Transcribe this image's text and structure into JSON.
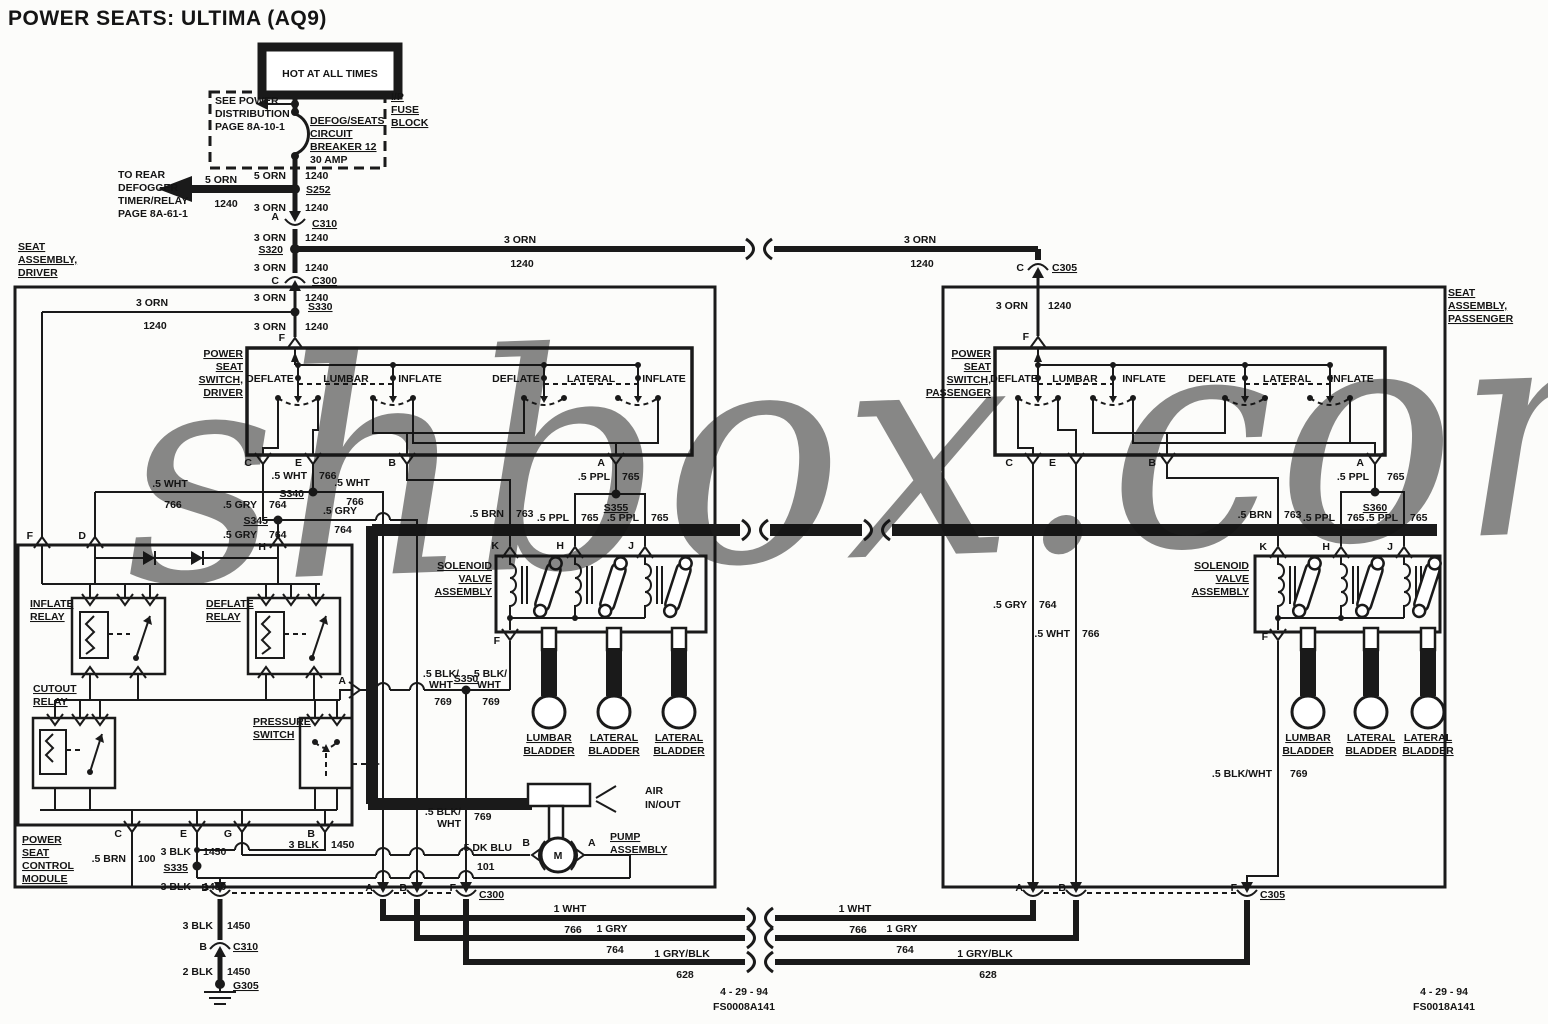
{
  "title": "POWER SEATS: ULTIMA (AQ9)",
  "watermark": "shbox.com",
  "colors": {
    "ink": "#1a1a1a",
    "watermark": "#8f99e6",
    "paper": "#fcfcfa"
  },
  "header": {
    "hot": "HOT AT ALL TIMES",
    "see_power": [
      "SEE POWER",
      "DISTRIBUTION",
      "PAGE 8A-10-1"
    ],
    "fuse_block": [
      "I/P",
      "FUSE",
      "BLOCK"
    ],
    "breaker": [
      "DEFOG/SEATS",
      "CIRCUIT",
      "BREAKER 12",
      "30 AMP"
    ],
    "to_rear": [
      "TO REAR",
      "DEFOGGER",
      "TIMER/RELAY",
      "PAGE 8A-61-1"
    ]
  },
  "boxes": {
    "seat_driver": [
      "SEAT",
      "ASSEMBLY,",
      "DRIVER"
    ],
    "seat_passenger": [
      "SEAT",
      "ASSEMBLY,",
      "PASSENGER"
    ],
    "switch_driver": [
      "POWER",
      "SEAT",
      "SWITCH,",
      "DRIVER"
    ],
    "switch_passenger": [
      "POWER",
      "SEAT",
      "SWITCH,",
      "PASSENGER"
    ],
    "module": [
      "POWER",
      "SEAT",
      "CONTROL",
      "MODULE"
    ],
    "solenoid": [
      "SOLENOID",
      "VALVE",
      "ASSEMBLY"
    ],
    "inflate_relay": [
      "INFLATE",
      "RELAY"
    ],
    "deflate_relay": [
      "DEFLATE",
      "RELAY"
    ],
    "cutout_relay": [
      "CUTOUT",
      "RELAY"
    ],
    "pressure_switch": [
      "PRESSURE",
      "SWITCH"
    ],
    "pump": [
      "PUMP",
      "ASSEMBLY"
    ],
    "air": [
      "AIR",
      "IN/OUT"
    ],
    "lumbar_bladder": [
      "LUMBAR",
      "BLADDER"
    ],
    "lateral_bladder": [
      "LATERAL",
      "BLADDER"
    ]
  },
  "switch": {
    "deflate": "DEFLATE",
    "lumbar": "LUMBAR",
    "inflate": "INFLATE",
    "lateral": "LATERAL"
  },
  "wires": {
    "orn5": "5 ORN",
    "orn3": "3 ORN",
    "n1240": "1240",
    "wht05": ".5 WHT",
    "n766": "766",
    "gry05": ".5 GRY",
    "n764": "764",
    "ppl05": ".5 PPL",
    "n765": "765",
    "brn05": ".5 BRN",
    "n763": "763",
    "n100": "100",
    "blkwht1": ".5 BLK/",
    "blkwht2": "WHT",
    "blkwht": ".5 BLK/WHT",
    "n769": "769",
    "dkblu05": ".5 DK BLU",
    "n101": "101",
    "blk3": "3 BLK",
    "n1450": "1450",
    "blk2": "2 BLK",
    "wht1": "1 WHT",
    "gry1": "1 GRY",
    "gryblk1": "1 GRY/BLK",
    "n628": "628"
  },
  "splices": {
    "s252": "S252",
    "s320": "S320",
    "s330": "S330",
    "s335": "S335",
    "s340": "S340",
    "s345": "S345",
    "s350": "S350",
    "s355": "S355",
    "s360": "S360"
  },
  "connectors": {
    "c300": "C300",
    "c305": "C305",
    "c310": "C310",
    "g305": "G305"
  },
  "pins": {
    "a": "A",
    "b": "B",
    "c": "C",
    "d": "D",
    "e": "E",
    "f": "F",
    "g": "G",
    "h": "H",
    "j": "J",
    "k": "K"
  },
  "motor": "M",
  "footer": {
    "date": "4 - 29 - 94",
    "code_left": "FS0008A141",
    "code_right": "FS0018A141"
  }
}
